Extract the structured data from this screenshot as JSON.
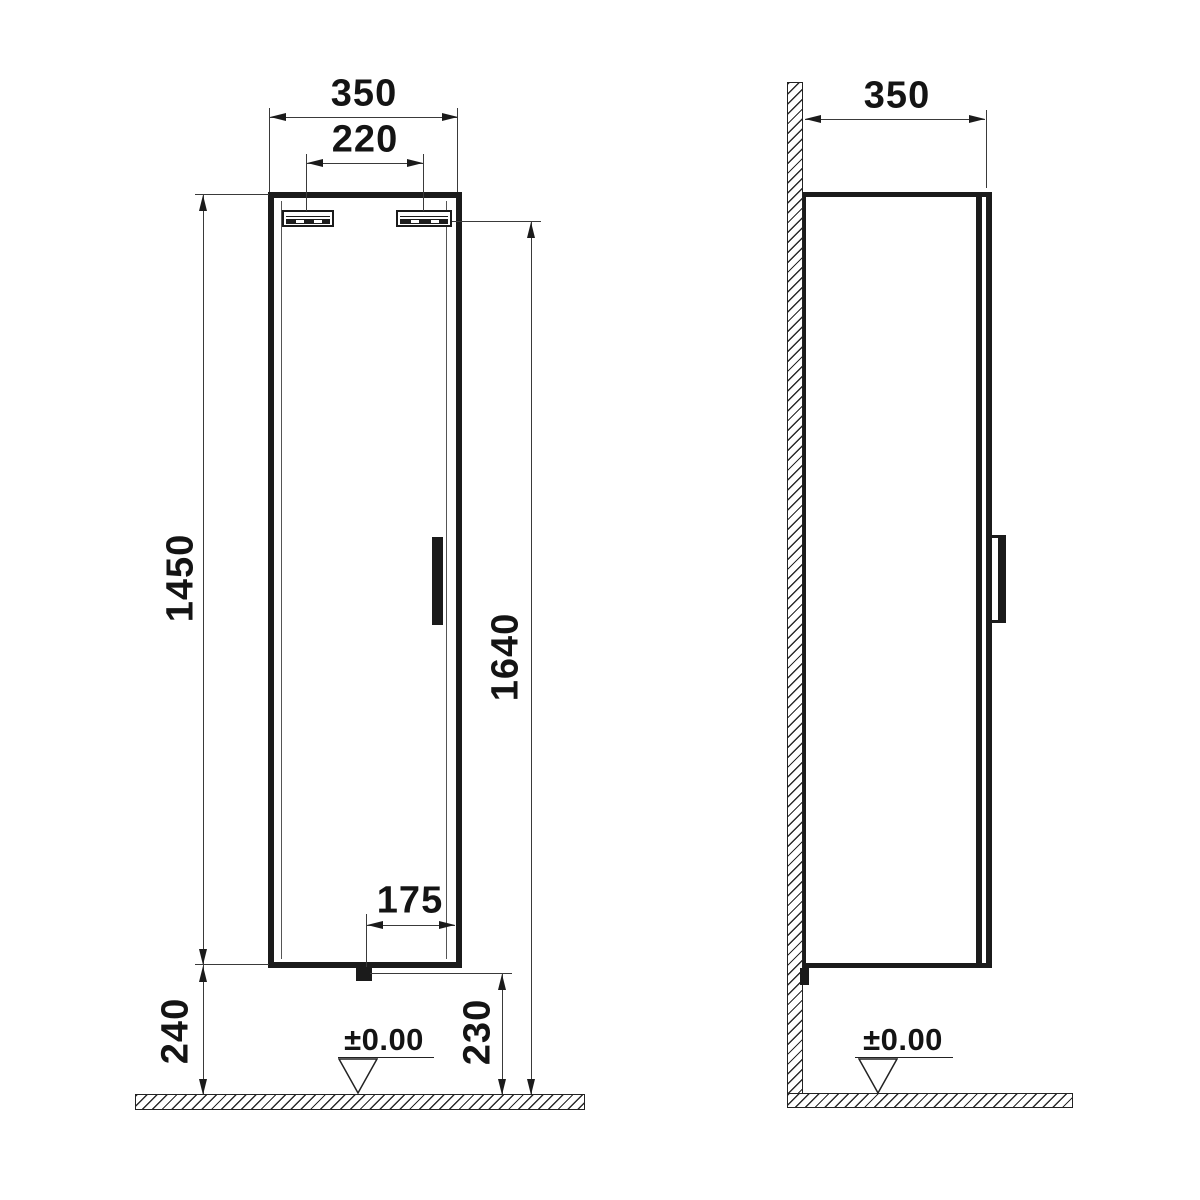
{
  "front_view": {
    "dim_overall_width": "350",
    "dim_hanger_centers": "220",
    "dim_cabinet_height": "1450",
    "dim_mounting_height": "1640",
    "dim_trap_offset": "175",
    "dim_floor_to_cabinet": "240",
    "dim_floor_to_trap": "230",
    "datum_level": "±0.00"
  },
  "side_view": {
    "dim_overall_depth": "350",
    "datum_level": "±0.00"
  },
  "colors": {
    "line": "#1b1b1b",
    "background": "#ffffff"
  }
}
